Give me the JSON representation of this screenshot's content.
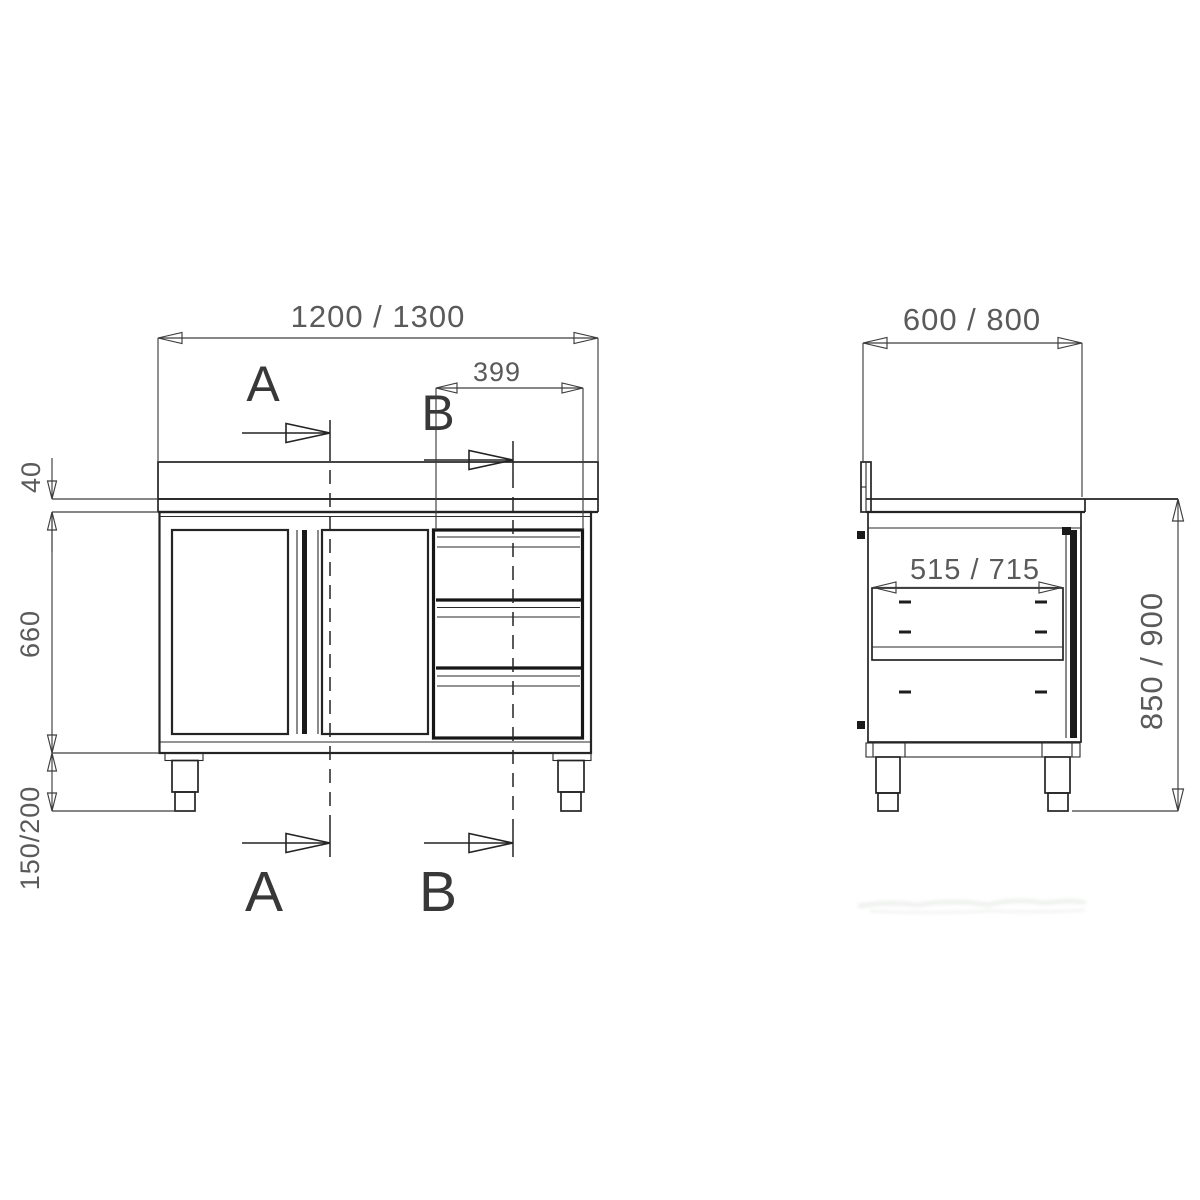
{
  "drawing": {
    "type": "technical-drawing",
    "subject": "stainless work cabinet with sliding doors and drawer unit, front and side orthographic views",
    "colors": {
      "background": "#ffffff",
      "outline": "#242424",
      "heavy_outline": "#161616",
      "dimension_line": "#3d3d3d",
      "dimension_text": "#5a5a5a",
      "section_label": "#383838"
    },
    "front_view": {
      "dim_width": "1200 / 1300",
      "dim_drawer_unit_width": "399",
      "dim_worktop_thickness": "40",
      "dim_body_height": "660",
      "dim_leg_height": "150/200",
      "section_label_a": "A",
      "section_label_b": "B"
    },
    "side_view": {
      "dim_depth": "600 / 800",
      "dim_inner_depth": "515 / 715",
      "dim_overall_height": "850 / 900"
    }
  }
}
